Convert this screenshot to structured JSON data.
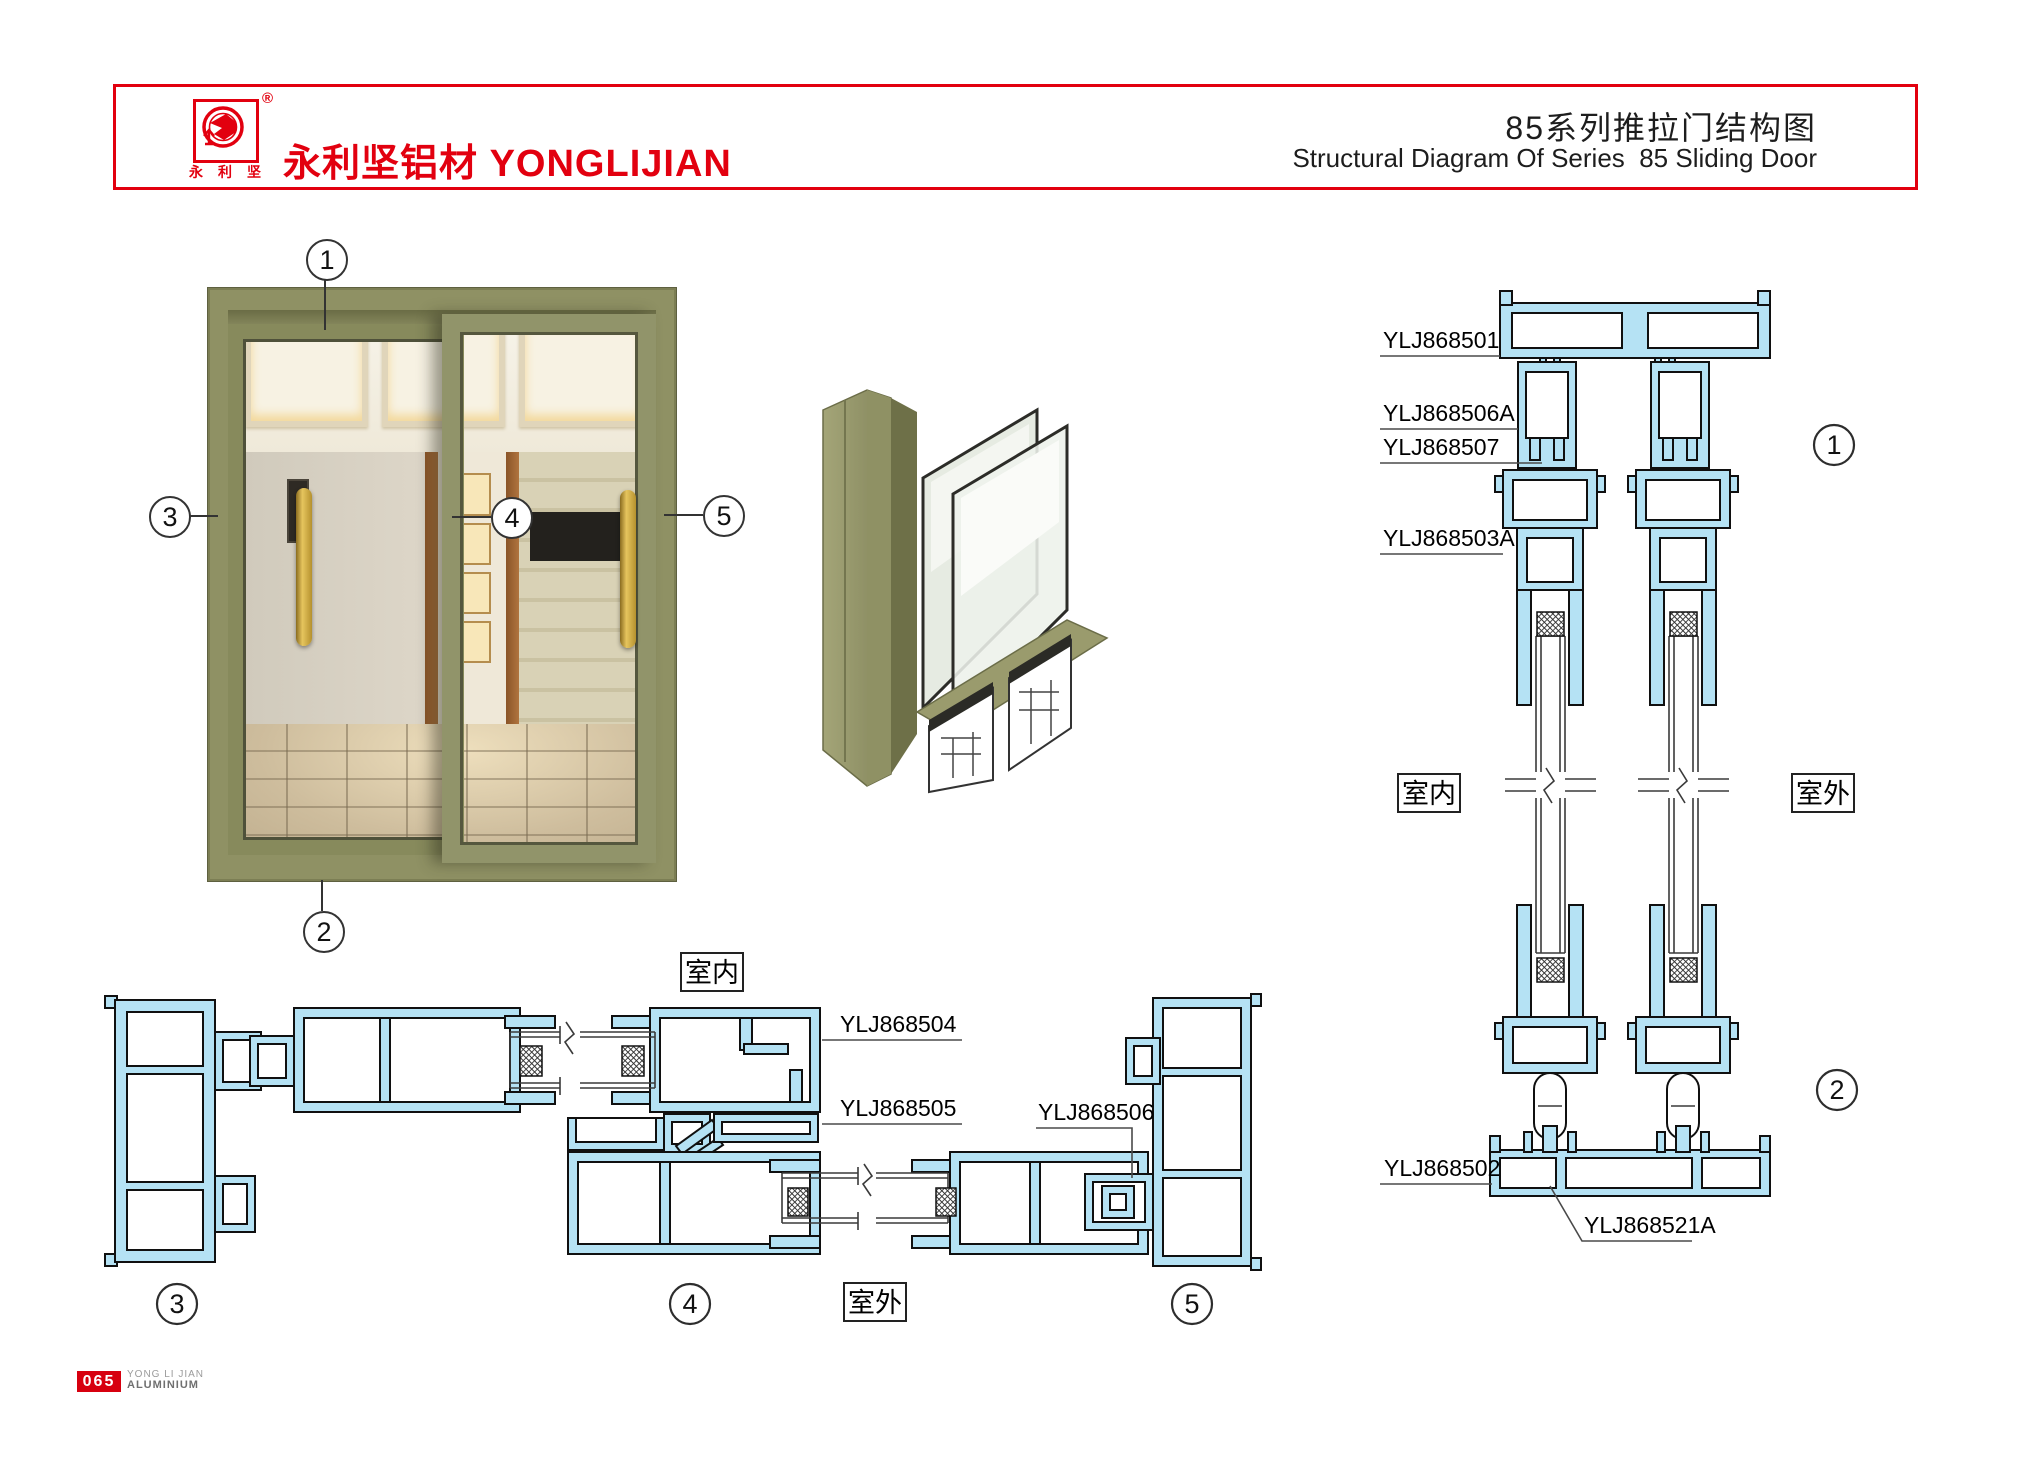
{
  "header": {
    "title_cn": "85系列推拉门结构图",
    "title_en": "Structural Diagram Of Series  85 Sliding Door",
    "brand_cn": "永利坚铝材",
    "brand_en": "YONGLIJIAN",
    "registered_mark": "®",
    "logo_chars": [
      "永",
      "利",
      "坚"
    ]
  },
  "footer": {
    "page_number": "065",
    "line1": "YONG LI JIAN",
    "line2": "ALUMINIUM"
  },
  "labels": {
    "indoor": "室内",
    "outdoor": "室外"
  },
  "vertical_section": {
    "p501": "YLJ868501",
    "p506a": "YLJ868506A",
    "p507": "YLJ868507",
    "p503a": "YLJ868503A",
    "p502": "YLJ868502",
    "p521a": "YLJ868521A"
  },
  "horizontal_section": {
    "p504": "YLJ868504",
    "p505": "YLJ868505",
    "p506": "YLJ868506"
  },
  "callouts": {
    "c1": "1",
    "c2": "2",
    "c3": "3",
    "c4": "4",
    "c5": "5"
  },
  "colors": {
    "accent_red": "#e2000f",
    "profile_fill": "#b5e2f4",
    "profile_stroke": "#101010",
    "frame_olive": "#8f9164",
    "handle_gold": "#c8a64b"
  }
}
